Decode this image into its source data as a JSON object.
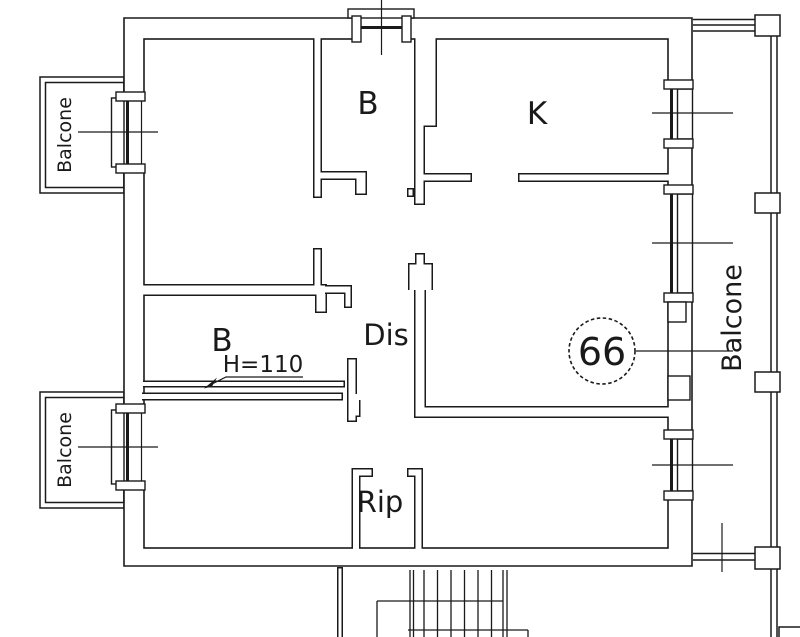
{
  "floor_plan": {
    "rooms": {
      "bathroom_top": "B",
      "kitchen": "K",
      "bathroom_lower": "B",
      "hallway": "Dis",
      "storage": "Rip"
    },
    "annotations": {
      "ceiling_height": "H=110",
      "unit_number": "66"
    },
    "balconies": {
      "left_upper": "Balcone",
      "left_lower": "Balcone",
      "right": "Balcone"
    },
    "colors": {
      "line": "#1a1a1a",
      "background": "#ffffff"
    }
  }
}
